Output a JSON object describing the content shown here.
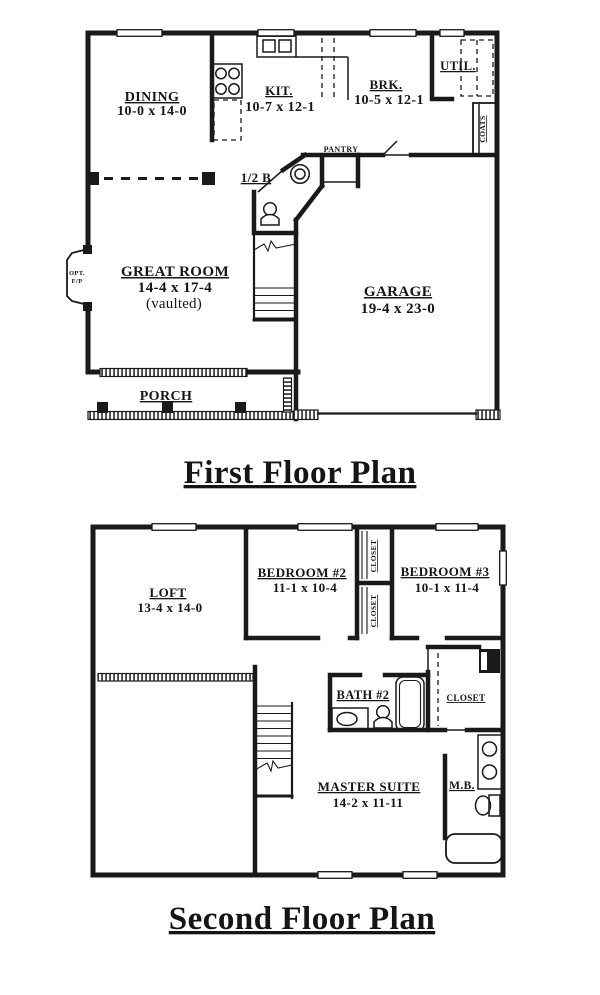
{
  "document": {
    "background": "#ffffff",
    "ink": "#1a1a1a",
    "type": "two-story house floor plan drawing"
  },
  "first_floor": {
    "title": "First Floor Plan",
    "rooms": {
      "dining": {
        "name": "DINING",
        "dims": "10-0 x 14-0"
      },
      "kitchen": {
        "name": "KIT.",
        "dims": "10-7 x 12-1"
      },
      "breakfast": {
        "name": "BRK.",
        "dims": "10-5 x 12-1"
      },
      "utility": {
        "name": "UTIL."
      },
      "coats": {
        "name": "COATS"
      },
      "pantry": {
        "name": "PANTRY"
      },
      "half_bath": {
        "name": "1/2 B"
      },
      "great_room": {
        "name": "GREAT ROOM",
        "dims": "14-4 x 17-4",
        "note": "(vaulted)"
      },
      "fireplace": {
        "line1": "OPT.",
        "line2": "F/P"
      },
      "garage": {
        "name": "GARAGE",
        "dims": "19-4 x 23-0"
      },
      "porch": {
        "name": "PORCH"
      }
    },
    "fixtures": [
      "range-icon",
      "double-sink-icon",
      "toilet-icon",
      "pedestal-sink-icon",
      "stairs-up",
      "porch-posts",
      "garage-door"
    ]
  },
  "second_floor": {
    "title": "Second Floor Plan",
    "rooms": {
      "loft": {
        "name": "LOFT",
        "dims": "13-4 x 14-0"
      },
      "bedroom2": {
        "name": "BEDROOM #2",
        "dims": "11-1 x 10-4"
      },
      "closet_a": {
        "name": "CLOSET"
      },
      "closet_b": {
        "name": "CLOSET"
      },
      "bedroom3": {
        "name": "BEDROOM #3",
        "dims": "10-1 x 11-4"
      },
      "bath2": {
        "name": "BATH #2"
      },
      "walk_in_closet": {
        "name": "CLOSET"
      },
      "master_suite": {
        "name": "MASTER SUITE",
        "dims": "14-2 x 11-11"
      },
      "master_bath": {
        "name": "M.B."
      }
    },
    "fixtures": [
      "tub-icon",
      "vanity-sink-icon",
      "toilet-icon",
      "toilet-figure-icon",
      "stairs-down",
      "stair-railing",
      "closet-rod"
    ]
  }
}
